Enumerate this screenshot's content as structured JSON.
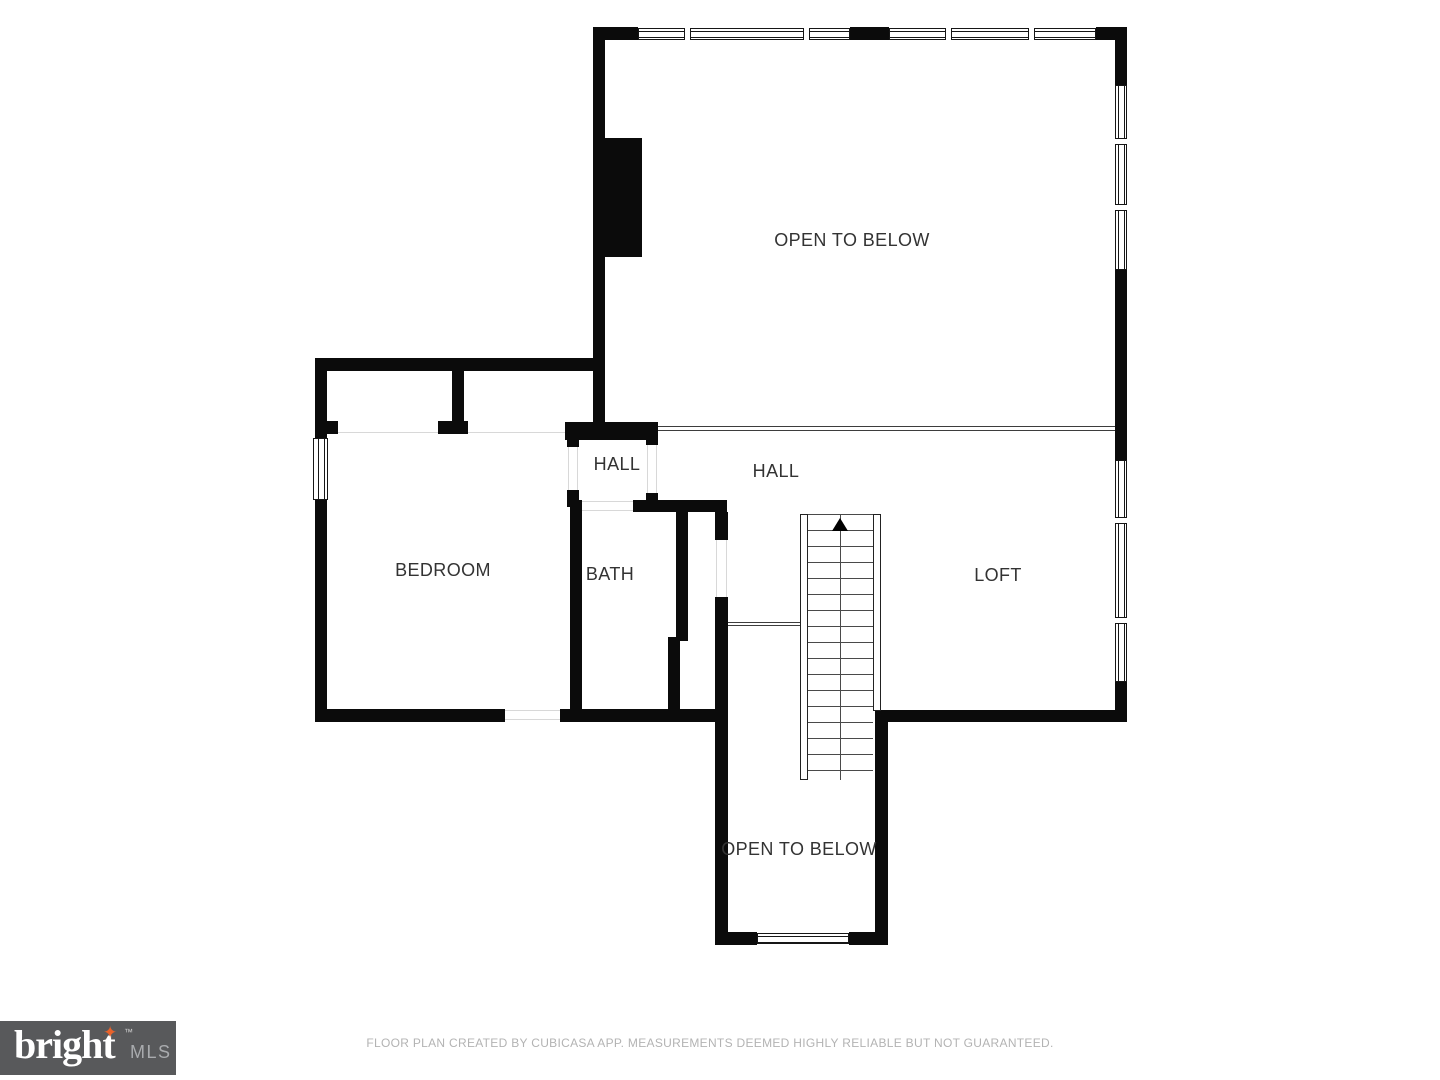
{
  "plan": {
    "rooms": [
      {
        "id": "open-to-below-upper",
        "label": "OPEN TO BELOW"
      },
      {
        "id": "hall-small",
        "label": "HALL"
      },
      {
        "id": "hall-main",
        "label": "HALL"
      },
      {
        "id": "bedroom",
        "label": "BEDROOM"
      },
      {
        "id": "bath",
        "label": "BATH"
      },
      {
        "id": "loft",
        "label": "LOFT"
      },
      {
        "id": "open-to-below-lower",
        "label": "OPEN TO BELOW"
      }
    ],
    "stairs": {
      "direction_icon": "up-arrow"
    }
  },
  "colors": {
    "wall": "#0b0b0b",
    "background": "#ffffff",
    "label_text": "#333333",
    "footer_text": "#b3b3b3",
    "logo_bg": "#58595b",
    "logo_brand_text": "#ffffff",
    "logo_mls_text": "#a9abae",
    "logo_star": "#e8632c"
  },
  "branding": {
    "logo_text": "bright",
    "logo_suffix": "MLS",
    "trademark": "™",
    "star_icon": "four-point-star-icon",
    "star_glyph": "✦"
  },
  "footer": {
    "disclaimer": "FLOOR PLAN CREATED BY CUBICASA APP. MEASUREMENTS DEEMED HIGHLY RELIABLE BUT NOT GUARANTEED."
  }
}
